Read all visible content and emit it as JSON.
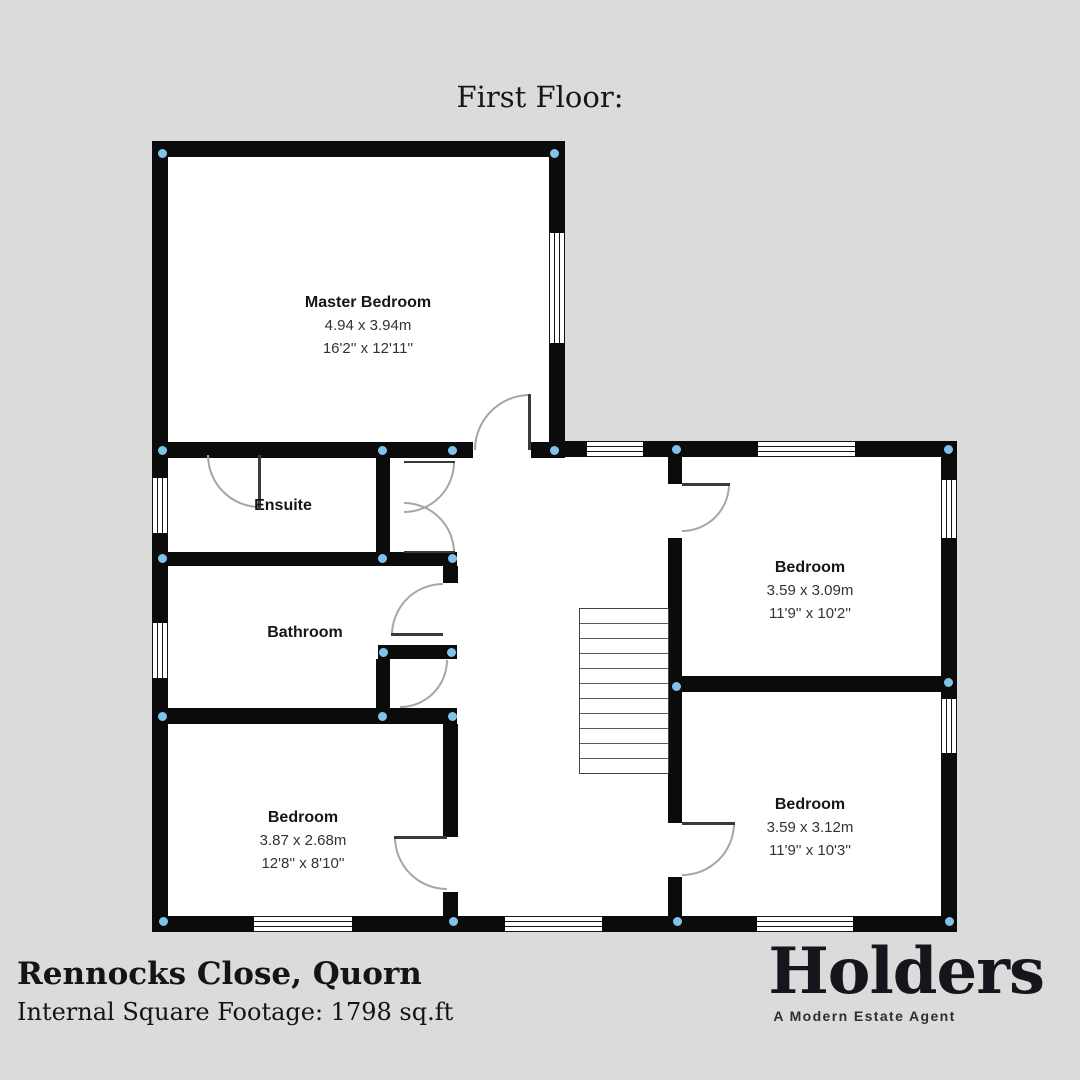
{
  "title": "First Floor:",
  "rooms": {
    "master": {
      "name": "Master Bedroom",
      "metric": "4.94 x 3.94m",
      "imperial": "16'2'' x 12'11''"
    },
    "ensuite": {
      "name": "Ensuite"
    },
    "bathroom": {
      "name": "Bathroom"
    },
    "bedroom_left": {
      "name": "Bedroom",
      "metric": "3.87 x 2.68m",
      "imperial": "12'8'' x 8'10''"
    },
    "bedroom_top_right": {
      "name": "Bedroom",
      "metric": "3.59 x 3.09m",
      "imperial": "11'9'' x 10'2''"
    },
    "bedroom_bottom_right": {
      "name": "Bedroom",
      "metric": "3.59 x 3.12m",
      "imperial": "11'9'' x 10'3''"
    }
  },
  "footer": {
    "address": "Rennocks Close, Quorn",
    "square_footage": "Internal Square Footage: 1798 sq.ft"
  },
  "brand": {
    "logo": "Holders",
    "tagline": "A Modern Estate Agent"
  },
  "colors": {
    "background": "#dbdbdb",
    "floor": "#ffffff",
    "wall": "#0b0b0b",
    "junction_dot": "#7ec3e8"
  }
}
